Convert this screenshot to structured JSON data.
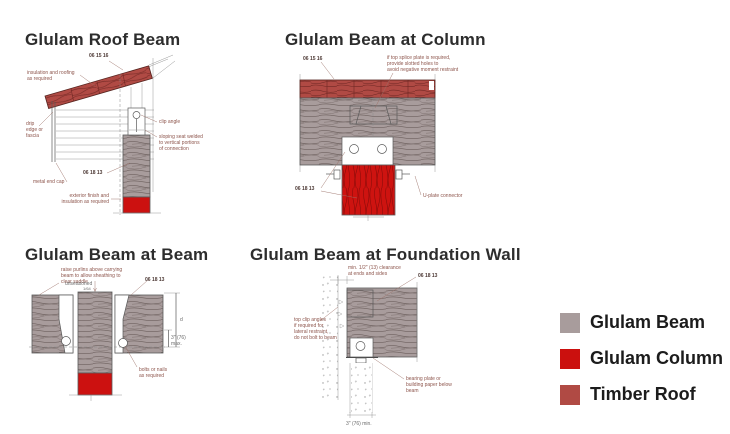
{
  "page": {
    "background": "#ffffff"
  },
  "palette": {
    "glulam_beam": "#a89c9c",
    "glulam_column": "#cc1110",
    "timber_roof": "#b04a44",
    "line": "#5a5a5a",
    "annotation": "#8d554c"
  },
  "diagrams": {
    "roof_beam": {
      "title": "Glulam Roof Beam",
      "labels": {
        "ref_roof": "06 15 16",
        "insulation": "insulation and roofing\nas required",
        "drip_edge": "drip\nedge or\nfascia",
        "metal_end_cap": "metal end cap",
        "clip_angle": "clip angle",
        "sloping_seat": "sloping seat welded\nto vertical portions\nof connection",
        "ref_beam": "06 18 13",
        "exterior_finish": "exterior finish and\ninsulation as required"
      }
    },
    "beam_at_column": {
      "title": "Glulam Beam at Column",
      "labels": {
        "ref_roof": "06 15 16",
        "splice_note": "if top splice plate is required,\nprovide slotted holes to\navoid negative moment restraint",
        "ref_beam": "06 18 13",
        "u_plate": "U-plate connector"
      }
    },
    "beam_at_beam": {
      "title": "Glulam Beam at Beam",
      "labels": {
        "purlin_note": "raise purlins above carrying\nbeam to allow sheathing to\nclear saddle",
        "unseasoned": "unseasoned",
        "unseasoned_dim": "1/64",
        "ref_beam": "06 18 13",
        "dim_max": "3\" (76)\nmax.",
        "dim_depth": "d",
        "bolts": "bolts or nails\nas required"
      }
    },
    "foundation_wall": {
      "title": "Glulam Beam at Foundation Wall",
      "labels": {
        "clearance": "min. 1/2\" (13) clearance\nat ends and sides",
        "ref_beam": "06 18 13",
        "clip_angles": "top clip angles\nif required for\nlateral restraint,\ndo not bolt to beam",
        "bearing_plate": "bearing plate or\nbuilding paper below\nbeam",
        "dim_min": "3\" (76) min."
      }
    }
  },
  "legend": {
    "items": [
      {
        "label": "Glulam Beam",
        "color": "#a89c9c"
      },
      {
        "label": "Glulam Column",
        "color": "#cb100e"
      },
      {
        "label": "Timber Roof",
        "color": "#b04a44"
      }
    ]
  }
}
